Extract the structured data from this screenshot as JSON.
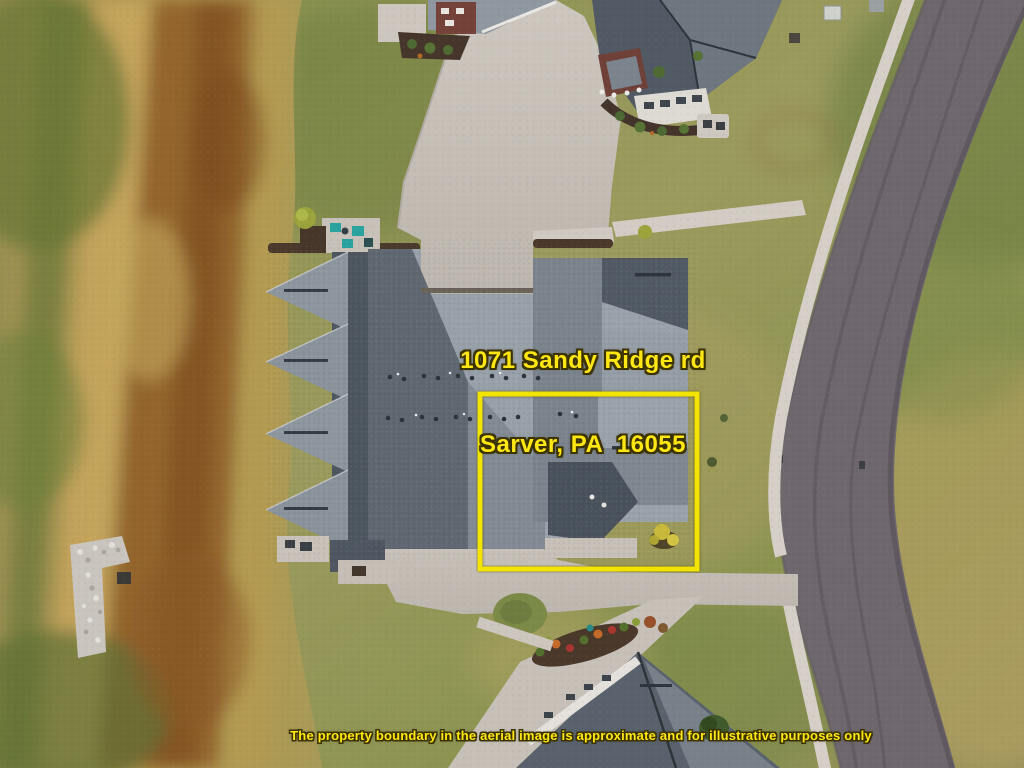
{
  "meta": {
    "type": "aerial-drone-property-photo",
    "width_px": 1024,
    "height_px": 768
  },
  "annotation": {
    "address_line1": "1071 Sandy Ridge rd",
    "address_line2": "Sarver, PA  16055",
    "disclaimer": "The property boundary in the aerial image is approximate and for illustrative purposes only"
  },
  "colors": {
    "boundary_yellow": "#F2E400",
    "annotation_text_yellow": "#FFE714",
    "annotation_text_outline": "#3B3300",
    "road_asphalt": "#6F676E",
    "sidewalk_concrete": "#D5CFC7",
    "driveway_concrete": "#C6C0B8",
    "roof_light_gray": "#99A1AA",
    "roof_dark_gray": "#545D67",
    "lawn_green": "#8A9150",
    "field_gold": "#B3994F",
    "field_rust": "#8A5424",
    "patio_furniture_teal": "#2AA3A0"
  },
  "scene": {
    "items": [
      "rough-hay-field",
      "rock-pile",
      "mowed-lawn",
      "townhome-building-roof",
      "shared-driveway",
      "rear-patio-teal-furniture",
      "curved-asphalt-street",
      "concrete-sidewalk",
      "neighbor-house-top-left",
      "neighbor-house-top",
      "neighbor-house-bottom",
      "grass-island",
      "landscape-beds",
      "property-boundary-box"
    ]
  }
}
